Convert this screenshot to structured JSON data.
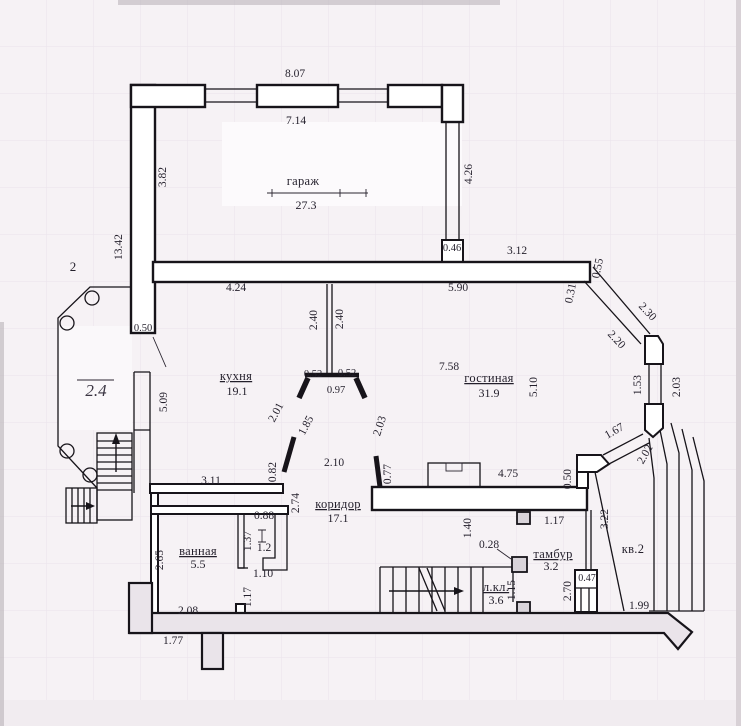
{
  "meta": {
    "kind": "scanned floor plan drawing",
    "language": "ru"
  },
  "colors": {
    "paper": "#f6f2f5",
    "grid": "#e6dee8",
    "line": "#17141a",
    "text": "#231f2b",
    "band_fill": "#eae4ea"
  },
  "plan": {
    "rooms": [
      {
        "name": "гараж",
        "area": "27.3",
        "x": 303,
        "y": 185,
        "ax": 306,
        "ay": 209,
        "u": false
      },
      {
        "name": "кухня",
        "area": "19.1",
        "x": 236,
        "y": 380,
        "ax": 237,
        "ay": 395,
        "u": true
      },
      {
        "name": "гостиная",
        "area": "31.9",
        "x": 489,
        "y": 382,
        "ax": 489,
        "ay": 397,
        "u": true
      },
      {
        "name": "коридор",
        "area": "17.1",
        "x": 338,
        "y": 508,
        "ax": 338,
        "ay": 522,
        "u": true
      },
      {
        "name": "ванная",
        "area": "5.5",
        "x": 198,
        "y": 555,
        "ax": 198,
        "ay": 568,
        "u": true
      },
      {
        "name": "тамбур",
        "area": "3.2",
        "x": 553,
        "y": 558,
        "ax": 551,
        "ay": 570,
        "u": true
      },
      {
        "name": "л.кл.",
        "area": "3.6",
        "x": 496,
        "y": 591,
        "ax": 496,
        "ay": 604,
        "u": true
      },
      {
        "name": "кв.2",
        "area": "",
        "x": 633,
        "y": 553,
        "u": false
      }
    ],
    "dimensions": [
      {
        "t": "8.07",
        "x": 295,
        "y": 77,
        "r": 0
      },
      {
        "t": "7.14",
        "x": 296,
        "y": 124,
        "r": 0
      },
      {
        "t": "3.82",
        "x": 166,
        "y": 177,
        "r": -90
      },
      {
        "t": "4.26",
        "x": 472,
        "y": 174,
        "r": -90
      },
      {
        "t": "13.42",
        "x": 122,
        "y": 247,
        "r": -90
      },
      {
        "t": "4.24",
        "x": 236,
        "y": 291,
        "r": 0
      },
      {
        "t": "5.90",
        "x": 458,
        "y": 291,
        "r": 0
      },
      {
        "t": "0.46",
        "x": 452,
        "y": 251,
        "r": 0,
        "size": 10.5
      },
      {
        "t": "3.12",
        "x": 517,
        "y": 254,
        "r": 0
      },
      {
        "t": "0.55",
        "x": 601,
        "y": 269,
        "r": -78
      },
      {
        "t": "0.31",
        "x": 574,
        "y": 294,
        "r": -78
      },
      {
        "t": "2.30",
        "x": 645,
        "y": 314,
        "r": 47
      },
      {
        "t": "2.20",
        "x": 614,
        "y": 342,
        "r": 47
      },
      {
        "t": "1.53",
        "x": 641,
        "y": 385,
        "r": -90
      },
      {
        "t": "2.03",
        "x": 680,
        "y": 387,
        "r": -90
      },
      {
        "t": "0.50",
        "x": 143,
        "y": 331,
        "r": 0,
        "size": 10.5
      },
      {
        "t": "5.09",
        "x": 167,
        "y": 402,
        "r": -90
      },
      {
        "t": "2.40",
        "x": 317,
        "y": 320,
        "r": -90
      },
      {
        "t": "2.40",
        "x": 343,
        "y": 319,
        "r": -90
      },
      {
        "t": "0.52",
        "x": 313,
        "y": 377,
        "r": 0,
        "size": 10.5
      },
      {
        "t": "0.52",
        "x": 347,
        "y": 376,
        "r": 0,
        "size": 10.5
      },
      {
        "t": "0.97",
        "x": 336,
        "y": 393,
        "r": 0,
        "size": 10.5
      },
      {
        "t": "7.58",
        "x": 449,
        "y": 370,
        "r": 0
      },
      {
        "t": "5.10",
        "x": 537,
        "y": 387,
        "r": -90
      },
      {
        "t": "2.01",
        "x": 279,
        "y": 414,
        "r": -62
      },
      {
        "t": "1.85",
        "x": 309,
        "y": 427,
        "r": -62
      },
      {
        "t": "2.03",
        "x": 383,
        "y": 427,
        "r": -72
      },
      {
        "t": "2.10",
        "x": 334,
        "y": 466,
        "r": 0
      },
      {
        "t": "0.82",
        "x": 276,
        "y": 472,
        "r": -90
      },
      {
        "t": "0.77",
        "x": 391,
        "y": 474,
        "r": -90
      },
      {
        "t": "4.75",
        "x": 508,
        "y": 477,
        "r": 0
      },
      {
        "t": "0.50",
        "x": 571,
        "y": 479,
        "r": -90
      },
      {
        "t": "1.67",
        "x": 616,
        "y": 434,
        "r": -30
      },
      {
        "t": "2.02",
        "x": 648,
        "y": 456,
        "r": -60
      },
      {
        "t": "3.11",
        "x": 211,
        "y": 484,
        "r": 0
      },
      {
        "t": "2.74",
        "x": 299,
        "y": 503,
        "r": -90
      },
      {
        "t": "0.88",
        "x": 264,
        "y": 519,
        "r": 0
      },
      {
        "t": "1.37",
        "x": 251,
        "y": 541,
        "r": -90
      },
      {
        "t": "1.2",
        "x": 264,
        "y": 551,
        "r": 0
      },
      {
        "t": "1.10",
        "x": 263,
        "y": 577,
        "r": 0
      },
      {
        "t": "2.65",
        "x": 163,
        "y": 560,
        "r": -90
      },
      {
        "t": "1.17",
        "x": 251,
        "y": 597,
        "r": -90
      },
      {
        "t": "2.08",
        "x": 188,
        "y": 614,
        "r": 0
      },
      {
        "t": "1.77",
        "x": 173,
        "y": 644,
        "r": 0
      },
      {
        "t": "1.40",
        "x": 471,
        "y": 528,
        "r": -90
      },
      {
        "t": "1.17",
        "x": 554,
        "y": 524,
        "r": 0
      },
      {
        "t": "0.28",
        "x": 489,
        "y": 548,
        "r": 0
      },
      {
        "t": "1.15",
        "x": 515,
        "y": 590,
        "r": -90
      },
      {
        "t": "2.70",
        "x": 571,
        "y": 591,
        "r": -90
      },
      {
        "t": "0.47",
        "x": 587,
        "y": 581,
        "r": 0,
        "size": 10
      },
      {
        "t": "3.22",
        "x": 608,
        "y": 519,
        "r": -90
      },
      {
        "t": "1.99",
        "x": 639,
        "y": 609,
        "r": 0
      }
    ],
    "annotations": [
      {
        "t": "2",
        "x": 73,
        "y": 271,
        "style": "note"
      },
      {
        "t": "2.4",
        "x": 96,
        "y": 396,
        "style": "hand"
      }
    ]
  }
}
